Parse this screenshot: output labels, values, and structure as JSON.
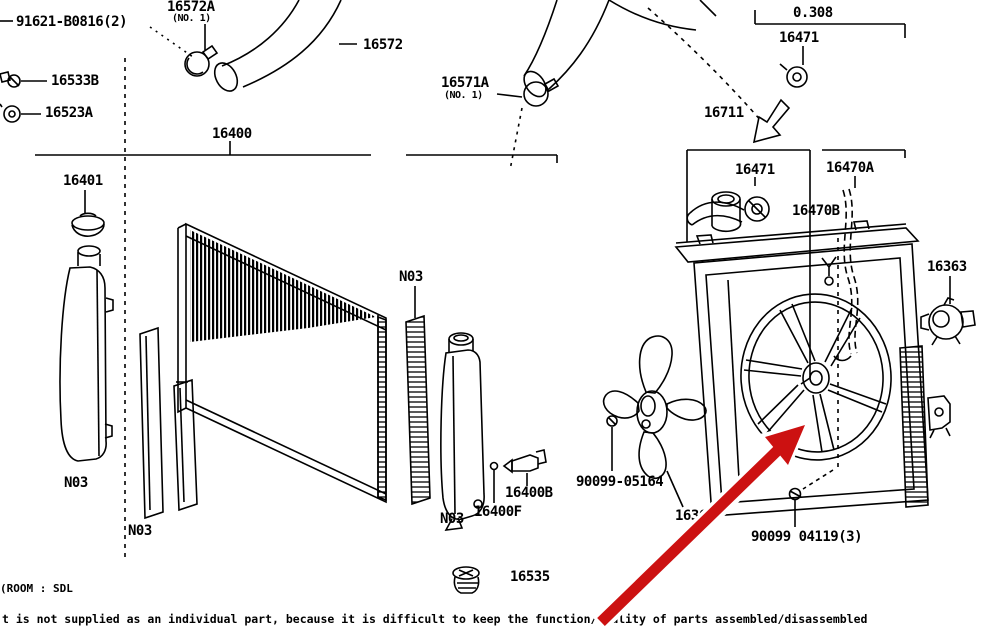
{
  "diagram_title": "radiator-and-fan-shroud-parts-diagram",
  "colors": {
    "background": "#ffffff",
    "line": "#000000",
    "arrow": "#cc1111",
    "halo": "#ffffff"
  },
  "labels": [
    {
      "id": "91621-b0816",
      "text": "91621-B0816(2)",
      "x": 16,
      "y": 15
    },
    {
      "id": "16572a",
      "text": "16572A",
      "x": 167,
      "y": 0
    },
    {
      "id": "16572a-note",
      "text": "(NO. 1)",
      "x": 172,
      "y": 14,
      "small": true
    },
    {
      "id": "16572",
      "text": "16572",
      "x": 363,
      "y": 38
    },
    {
      "id": "16533b",
      "text": "16533B",
      "x": 51,
      "y": 74
    },
    {
      "id": "16523a",
      "text": "16523A",
      "x": 45,
      "y": 106
    },
    {
      "id": "16400",
      "text": "16400",
      "x": 212,
      "y": 127
    },
    {
      "id": "16401",
      "text": "16401",
      "x": 63,
      "y": 174
    },
    {
      "id": "16571a",
      "text": "16571A",
      "x": 441,
      "y": 76
    },
    {
      "id": "16571a-note",
      "text": "(NO. 1)",
      "x": 444,
      "y": 91,
      "small": true
    },
    {
      "id": "16711",
      "text": "16711",
      "x": 704,
      "y": 106
    },
    {
      "id": "dim-0308",
      "text": "0.308",
      "x": 793,
      "y": 6
    },
    {
      "id": "16471-upper",
      "text": "16471",
      "x": 779,
      "y": 31
    },
    {
      "id": "16471-lower",
      "text": "16471",
      "x": 735,
      "y": 163
    },
    {
      "id": "16470a",
      "text": "16470A",
      "x": 826,
      "y": 161
    },
    {
      "id": "16470b",
      "text": "16470B",
      "x": 792,
      "y": 204
    },
    {
      "id": "16363",
      "text": "16363",
      "x": 927,
      "y": 260
    },
    {
      "id": "n03-right-seal",
      "text": "N03",
      "x": 399,
      "y": 270
    },
    {
      "id": "n03-left-tank",
      "text": "N03",
      "x": 64,
      "y": 476
    },
    {
      "id": "n03-left-seal",
      "text": "N03",
      "x": 128,
      "y": 524
    },
    {
      "id": "n03-right-tank",
      "text": "N03",
      "x": 440,
      "y": 512
    },
    {
      "id": "16400b",
      "text": "16400B",
      "x": 505,
      "y": 486
    },
    {
      "id": "16400f",
      "text": "16400F",
      "x": 474,
      "y": 505
    },
    {
      "id": "90099-05164",
      "text": "90099-05164",
      "x": 576,
      "y": 475
    },
    {
      "id": "16361",
      "text": "16361",
      "x": 675,
      "y": 509
    },
    {
      "id": "90099-04119",
      "text": "90099 04119(3)",
      "x": 751,
      "y": 530
    },
    {
      "id": "16535",
      "text": "16535",
      "x": 510,
      "y": 570
    }
  ],
  "footer": {
    "left_note": "(ROOM : SDL",
    "bottom_note": "t is not supplied as an individual part, because it is difficult to keep the function/quality of parts assembled/disassembled"
  }
}
